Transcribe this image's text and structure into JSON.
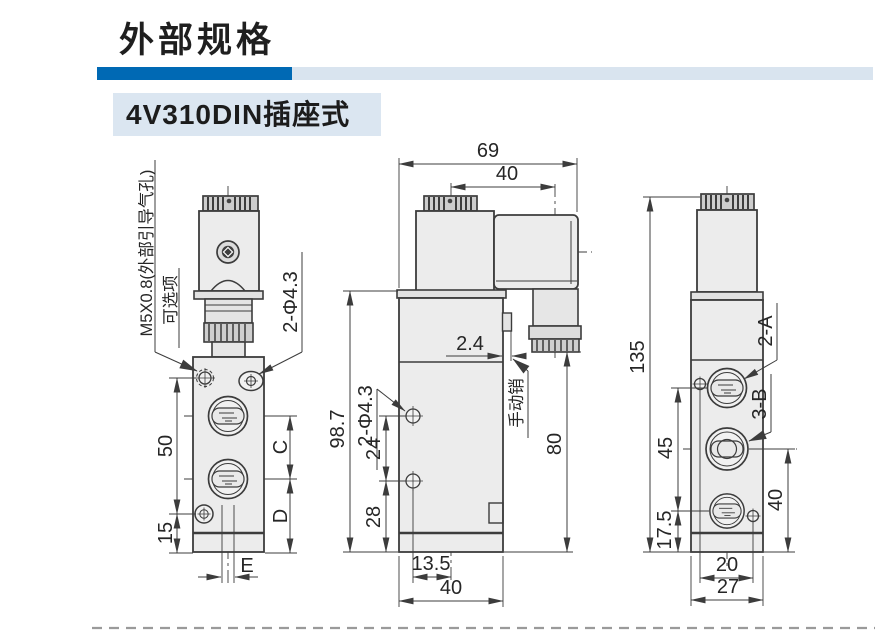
{
  "page": {
    "title": "外部规格",
    "subtitle": "4V310DIN插座式"
  },
  "colors": {
    "accent_blue": "#0069b4",
    "light_blue": "#d9e4ef",
    "subtitle_bg": "#dbe6f1"
  },
  "drawings": {
    "front_view": {
      "pilot_label": "M5X0.8(外部引导气孔)",
      "optional_label": "可选项",
      "holes_label": "2-Φ4.3",
      "dim_50": "50",
      "dim_15": "15",
      "dim_C": "C",
      "dim_D": "D",
      "dim_E": "E"
    },
    "side_view": {
      "dim_69": "69",
      "dim_40_top": "40",
      "holes_label": "2-Φ4.3",
      "dim_98_7": "98.7",
      "dim_24": "24",
      "dim_28": "28",
      "dim_2_4": "2.4",
      "manual_pin_label": "手动销",
      "dim_80": "80",
      "dim_13_5": "13.5",
      "dim_40_bottom": "40"
    },
    "back_view": {
      "dim_135": "135",
      "dim_45": "45",
      "dim_17_5": "17.5",
      "dim_40": "40",
      "dim_20": "20",
      "dim_27": "27",
      "port_a_label": "2-A",
      "port_b_label": "3-B"
    }
  }
}
